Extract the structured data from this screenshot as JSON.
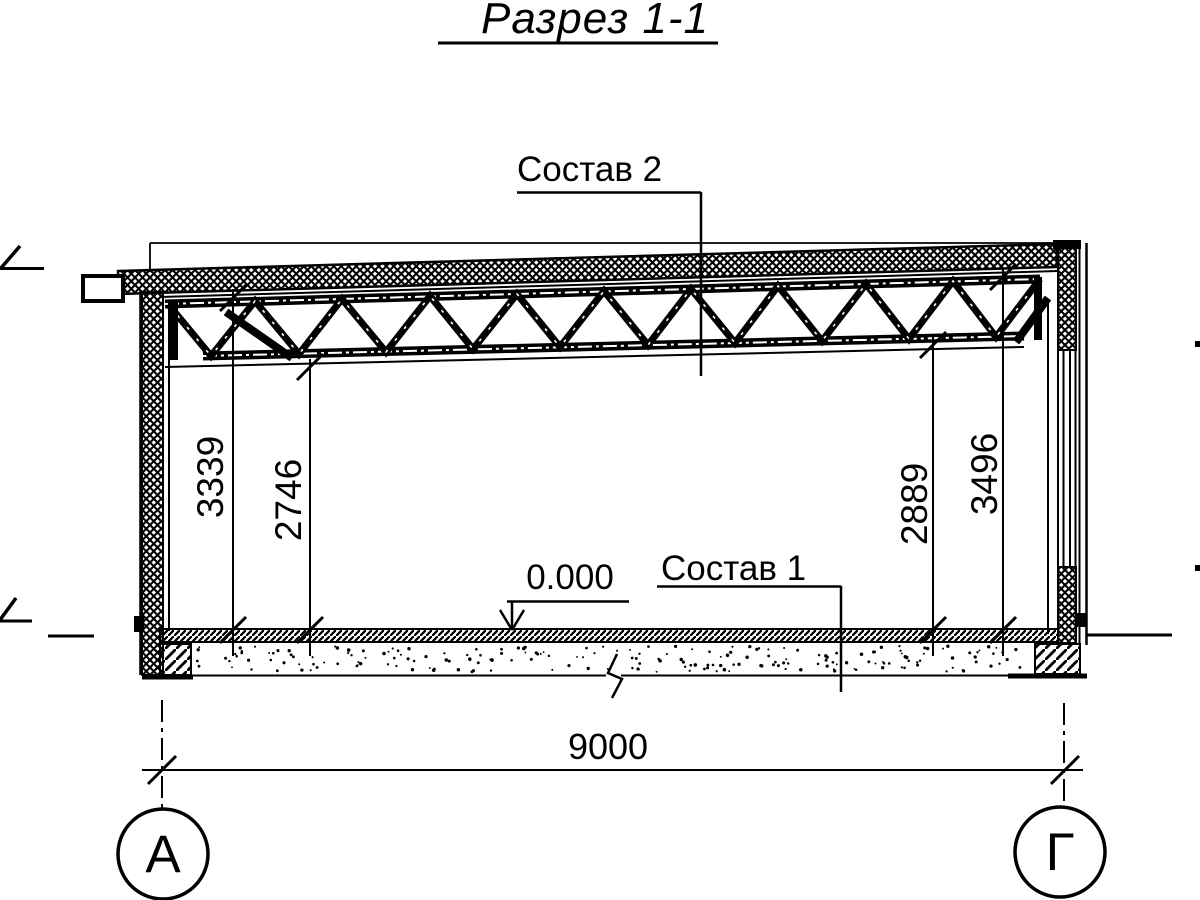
{
  "drawing": {
    "title": "Разрез 1-1",
    "callouts": {
      "roof_composition": "Состав 2",
      "floor_composition": "Состав 1"
    },
    "elevation_marks": {
      "floor_zero": "0.000"
    },
    "dimensions": {
      "vertical": [
        {
          "id": "left-to-top-chord",
          "value": "3339"
        },
        {
          "id": "left-to-bottom-chord",
          "value": "2746"
        },
        {
          "id": "right-to-bottom-chord",
          "value": "2889"
        },
        {
          "id": "right-to-top-chord",
          "value": "3496"
        }
      ],
      "horizontal_span": {
        "value": "9000"
      }
    },
    "axes": {
      "left": "А",
      "right": "Г"
    },
    "colors": {
      "ink": "#000000",
      "paper": "#ffffff"
    }
  }
}
